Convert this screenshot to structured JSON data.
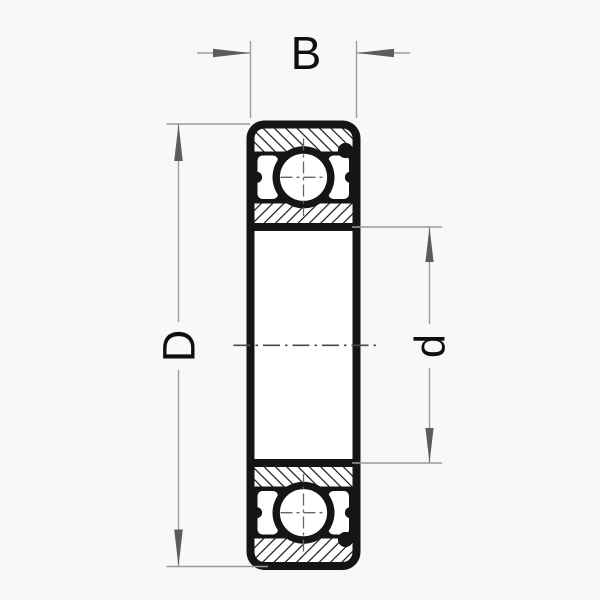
{
  "diagram": {
    "type": "deep-groove-ball-bearing-cross-section",
    "dimensions": {
      "width_label": "B",
      "outer_diameter_label": "D",
      "bore_diameter_label": "d"
    },
    "colors": {
      "background": "#f8f8f8",
      "drawing_ink": "#151515",
      "dimension_line": "#9b9b9b",
      "arrowhead": "#5c5c5c",
      "centerline": "#4a4a4a",
      "label_ink": "#0f0f0f"
    }
  }
}
